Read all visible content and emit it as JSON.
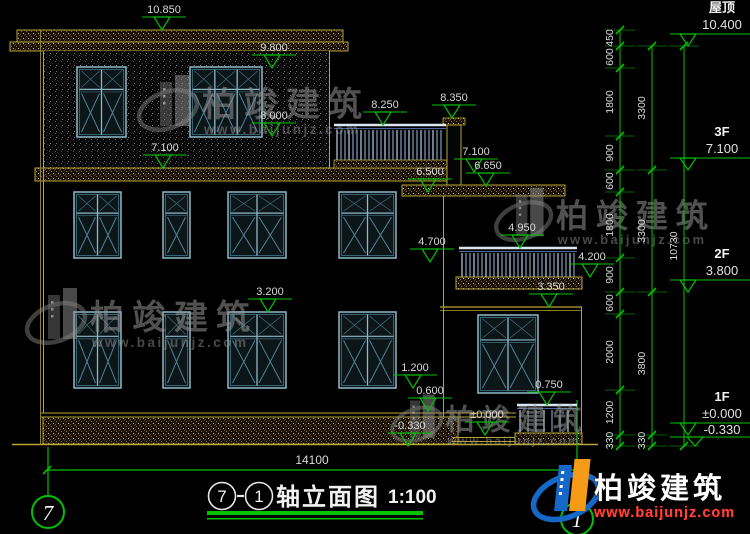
{
  "colors": {
    "green": "#00c200",
    "yellow": "#b6a433",
    "dim_text": "#d9d9d9",
    "frame_light": "#8fb8c8",
    "frame_dark": "#35616e",
    "glass_line": "#4f8496",
    "rail_light": "#d9e6f0",
    "rail_blue": "#7e9ec2",
    "logo_blue": "#1668c8",
    "logo_orange": "#f59b17"
  },
  "elevation_markers": [
    {
      "label": "10.850",
      "x": 162,
      "y": 30
    },
    {
      "label": "9.800",
      "x": 272,
      "y": 68
    },
    {
      "label": "8.000",
      "x": 272,
      "y": 136
    },
    {
      "label": "7.100",
      "x": 163,
      "y": 168
    },
    {
      "label": "8.250",
      "x": 383,
      "y": 125
    },
    {
      "label": "8.350",
      "x": 452,
      "y": 118
    },
    {
      "label": "7.100",
      "x": 474,
      "y": 172
    },
    {
      "label": "6.650",
      "x": 486,
      "y": 186
    },
    {
      "label": "6.500",
      "x": 428,
      "y": 192
    },
    {
      "label": "4.950",
      "x": 520,
      "y": 248
    },
    {
      "label": "4.700",
      "x": 430,
      "y": 262
    },
    {
      "label": "4.200",
      "x": 590,
      "y": 277
    },
    {
      "label": "3.350",
      "x": 549,
      "y": 307
    },
    {
      "label": "3.200",
      "x": 268,
      "y": 312
    },
    {
      "label": "1.200",
      "x": 413,
      "y": 388
    },
    {
      "label": "0.600",
      "x": 428,
      "y": 411
    },
    {
      "label": "0.750",
      "x": 547,
      "y": 405
    },
    {
      "label": "±0.000",
      "x": 485,
      "y": 435
    },
    {
      "label": "-0.330",
      "x": 408,
      "y": 446
    }
  ],
  "floors": [
    {
      "name": "屋顶",
      "value": "10.400",
      "apex_y": 46
    },
    {
      "name": "3F",
      "value": "7.100",
      "apex_y": 170
    },
    {
      "name": "2F",
      "value": "3.800",
      "apex_y": 292
    },
    {
      "name": "1F",
      "value": "±0.000",
      "apex_y": 435,
      "value2": "-0.330",
      "apex_y2": 446
    }
  ],
  "dim_chains": [
    {
      "x": 620,
      "ticks": [
        30,
        46,
        68,
        136,
        170,
        192,
        258,
        292,
        314,
        390,
        435,
        446
      ],
      "labels": [
        "450",
        "600",
        "1800",
        "900",
        "600",
        "1800",
        "900",
        "600",
        "2000",
        "1200",
        "330"
      ]
    },
    {
      "x": 652,
      "ticks": [
        46,
        170,
        292,
        435,
        446
      ],
      "labels": [
        "3300",
        "3300",
        "3800",
        "330"
      ]
    },
    {
      "x": 684,
      "ticks": [
        46,
        446
      ],
      "labels": [
        "10730"
      ]
    }
  ],
  "bottom_dim": {
    "label": "14100",
    "x1": 47,
    "x2": 577,
    "y": 470
  },
  "axis_bubbles": [
    {
      "label": "7",
      "cx": 48,
      "cy": 512
    },
    {
      "label": "1",
      "cx": 577,
      "cy": 519
    }
  ],
  "title": {
    "bubble1": "7",
    "separator": "-",
    "bubble2": "1",
    "name": "轴立面图",
    "scale": "1:100"
  },
  "watermark": {
    "cn": "柏竣建筑",
    "url": "www.baijunjz.com",
    "instances": [
      {
        "x": 140,
        "y": 72,
        "s": 1.0
      },
      {
        "x": 28,
        "y": 285,
        "s": 1.0
      },
      {
        "x": 497,
        "y": 185,
        "s": 0.95
      },
      {
        "x": 393,
        "y": 392,
        "s": 0.85
      }
    ]
  },
  "brand": {
    "cn": "柏竣建筑",
    "url": "www.baijunjz.com"
  },
  "windows": {
    "f3": {
      "top": 67,
      "bot": 137,
      "items": [
        {
          "x": 77,
          "w": 49,
          "panes": 2
        },
        {
          "x": 190,
          "w": 72,
          "panes": 3
        }
      ]
    },
    "f2": {
      "top": 192,
      "bot": 258,
      "items": [
        {
          "x": 74,
          "w": 47,
          "panes": 2
        },
        {
          "x": 163,
          "w": 27,
          "panes": 1
        },
        {
          "x": 228,
          "w": 58,
          "panes": 2
        },
        {
          "x": 339,
          "w": 57,
          "panes": 2
        }
      ]
    },
    "f1": {
      "top": 312,
      "bot": 388,
      "items": [
        {
          "x": 74,
          "w": 47,
          "panes": 2
        },
        {
          "x": 163,
          "w": 27,
          "panes": 1
        },
        {
          "x": 228,
          "w": 58,
          "panes": 2
        },
        {
          "x": 339,
          "w": 57,
          "panes": 2
        }
      ]
    },
    "annex": {
      "top": 315,
      "bot": 393,
      "items": [
        {
          "x": 478,
          "w": 60,
          "panes": 2
        }
      ]
    }
  },
  "railings": [
    {
      "x1": 334,
      "x2": 446,
      "top": 125,
      "bot": 160,
      "step": 4
    },
    {
      "x1": 459,
      "x2": 577,
      "top": 248,
      "bot": 277,
      "step": 4
    },
    {
      "x1": 517,
      "x2": 577,
      "top": 405,
      "bot": 432,
      "step": 8
    }
  ]
}
